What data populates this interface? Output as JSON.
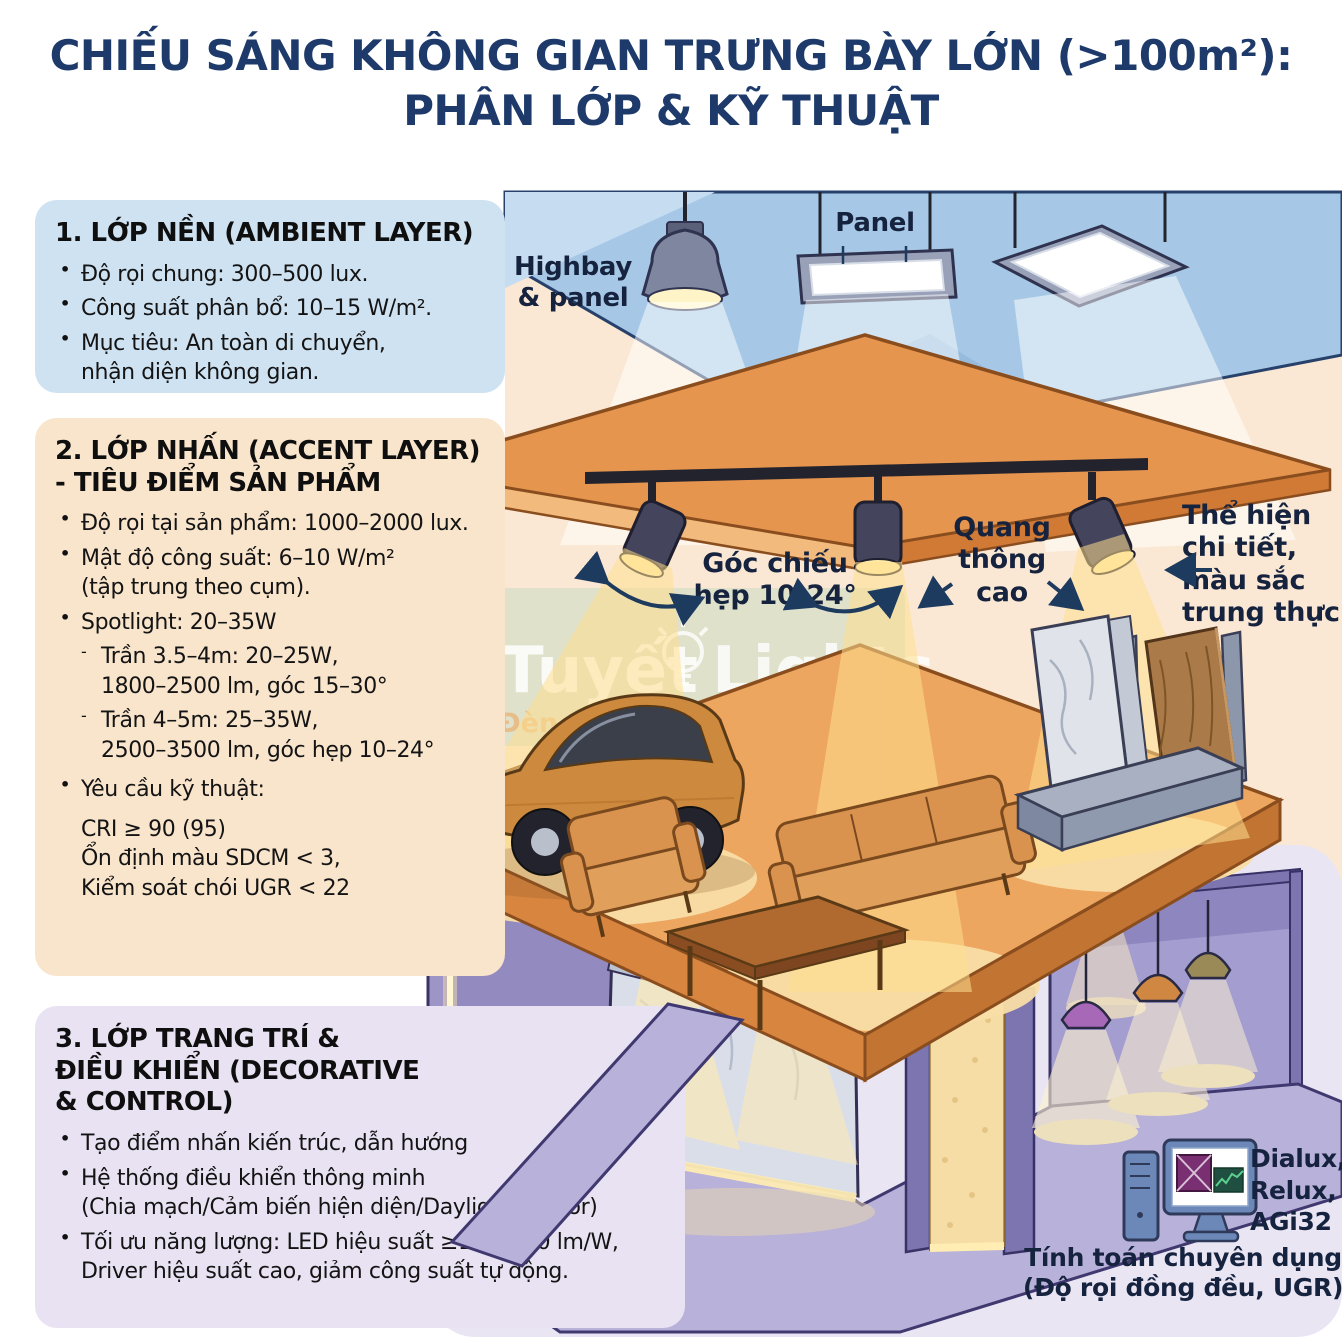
{
  "title": {
    "line1": "CHIẾU SÁNG KHÔNG GIAN TRƯNG BÀY LỚN (>100m²):",
    "line2": "PHÂN LỚP & KỸ THUẬT"
  },
  "layers": [
    {
      "heading_lines": [
        "1. LỚP NỀN (AMBIENT LAYER)"
      ],
      "bullets": [
        {
          "lines": [
            "Độ rọi chung: 300–500 lux."
          ]
        },
        {
          "lines": [
            "Công suất phân bổ: 10–15 W/m²."
          ]
        },
        {
          "lines": [
            "Mục tiêu: An toàn di chuyển,",
            "nhận diện không gian."
          ]
        }
      ]
    },
    {
      "heading_lines": [
        "2. LỚP NHẤN (ACCENT LAYER)",
        "- TIÊU ĐIỂM SẢN PHẨM"
      ],
      "bullets": [
        {
          "lines": [
            "Độ rọi tại sản phẩm: 1000–2000 lux."
          ]
        },
        {
          "lines": [
            "Mật độ công suất: 6–10 W/m²",
            "(tập trung theo cụm)."
          ]
        },
        {
          "lines": [
            "Spotlight: 20–35W"
          ]
        }
      ],
      "sub_bullets": [
        {
          "lines": [
            "Trần 3.5–4m: 20–25W,",
            "1800–2500 lm, góc 15–30°"
          ]
        },
        {
          "lines": [
            "Trần 4–5m: 25–35W,",
            "2500–3500 lm, góc hẹp 10–24°"
          ]
        }
      ],
      "requirements_bullet": {
        "lines": [
          "Yêu cầu kỹ thuật:"
        ]
      },
      "requirements": [
        "CRI ≥ 90 (95)",
        "Ổn định màu SDCM < 3,",
        "Kiểm soát chói UGR < 22"
      ]
    },
    {
      "heading_lines": [
        "3. LỚP TRANG TRÍ &",
        "ĐIỀU KHIỂN (DECORATIVE",
        "& CONTROL)"
      ],
      "bullets": [
        {
          "lines": [
            "Tạo điểm nhấn kiến trúc, dẫn hướng"
          ]
        },
        {
          "lines": [
            "Hệ thống điều khiển thông minh",
            "(Chia mạch/Cảm biến hiện diện/Daylight sensor)"
          ]
        },
        {
          "lines": [
            "Tối ưu năng lượng: LED hiệu suất ≥100–120 lm/W,",
            "Driver hiệu suất cao, giảm công suất tự động."
          ]
        }
      ]
    }
  ],
  "diagram_labels": {
    "highbay": {
      "lines": [
        "Highbay",
        "& panel"
      ]
    },
    "panel": "Panel",
    "beam_angle": {
      "lines": [
        "Góc chiếu",
        "hẹp 10-24°"
      ]
    },
    "luminous_flux": {
      "lines": [
        "Quang",
        "thông",
        "cao"
      ]
    },
    "color_fidelity": {
      "lines": [
        "Thể hiện",
        "chi tiết,",
        "màu sắc",
        "trung thực"
      ]
    },
    "software": {
      "lines": [
        "Dialux,",
        "Relux,",
        "AGi32"
      ]
    },
    "calculation": {
      "lines": [
        "Tính toán chuyên dụng",
        "(Độ rọi đồng đều, UGR)"
      ]
    }
  },
  "watermark": {
    "brand_left": "Tuyết",
    "brand_right": "Lights",
    "tagline_left": "Đèn chuẩn",
    "tagline_right": "gian chất",
    "bulb_icon": "lightbulb-icon"
  },
  "icons": {
    "software_tool": "computer-monitor-icon"
  },
  "colors": {
    "title_navy": "#1d3a6b",
    "ambient_panel_bg": "#cfe2f2",
    "accent_panel_bg": "#f9e4cc",
    "decor_panel_bg": "#e9e2f3",
    "ceiling_blue": "#a6c8e6",
    "canopy_orange": "#e6954f",
    "platform_orange": "#eda65f",
    "lower_level_purple": "#9c95c6",
    "warm_beam": "#ffdf8e",
    "label_text": "#16233f"
  }
}
